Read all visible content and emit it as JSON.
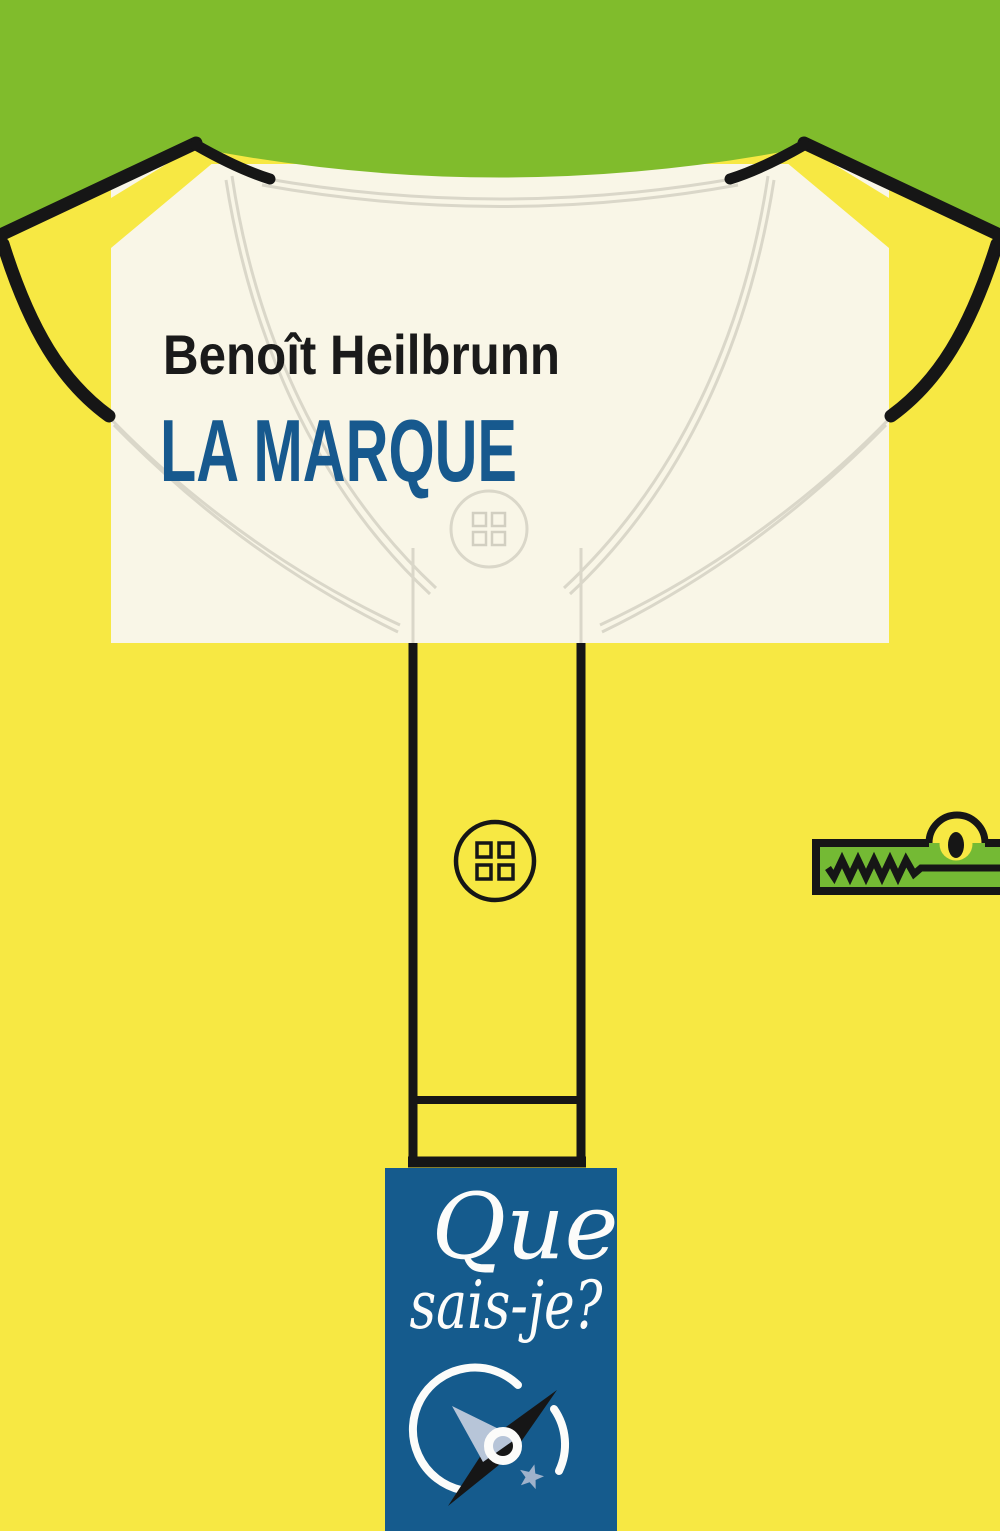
{
  "cover": {
    "author": "Benoît Heilbrunn",
    "title": "LA MARQUE",
    "collection": {
      "word1": "Que",
      "word2": "sais-je?"
    },
    "artwork": {
      "description_icons": [
        "polo-shirt-icon",
        "collar-stitching-icon",
        "shirt-button-icon",
        "crocodile-logo-icon",
        "compass-logo-icon",
        "star-icon"
      ]
    },
    "colors": {
      "green": "#80BC2C",
      "yellow": "#F7E843",
      "cream": "#F9F6E7",
      "black": "#161616",
      "title_blue": "#17598E",
      "author_black": "#1A1A1A",
      "banner_blue": "#155B8D",
      "banner_text": "#FCFCFA",
      "croc_green": "#74BA34",
      "line_gray": "#DAD7C9",
      "hole_gray": "#D2CFC1",
      "button_white": "#FFFFFF",
      "needle_silver": "#B7C5D8",
      "star_blue": "#9FB2CB"
    }
  }
}
